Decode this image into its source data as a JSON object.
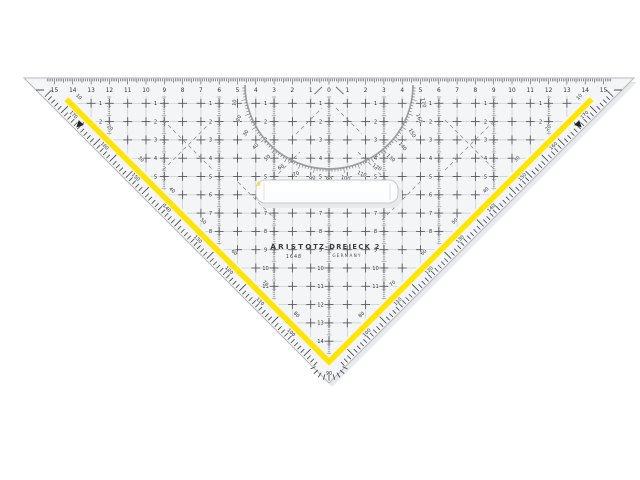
{
  "product": {
    "brand": "ARISTO",
    "model_number": "1648",
    "product_name": "TZ-DREIECK 2",
    "country": "GERMANY",
    "right_angle_label": "90"
  },
  "top_scale": {
    "unit_numbers": [
      "15",
      "14",
      "13",
      "12",
      "11",
      "10",
      "9",
      "8",
      "7",
      "6",
      "5",
      "4",
      "3",
      "2",
      "1",
      "0",
      "1",
      "2",
      "3",
      "4",
      "5",
      "6",
      "7",
      "8",
      "9",
      "10",
      "11",
      "12",
      "13",
      "14",
      "15"
    ]
  },
  "protractor": {
    "degree_labels": [
      "10",
      "20",
      "30",
      "40",
      "50",
      "60",
      "70",
      "80",
      "90",
      "100",
      "110",
      "120",
      "130",
      "140",
      "150",
      "160",
      "170"
    ]
  },
  "edge_scales": {
    "inner_degrees": [
      "10",
      "20",
      "30",
      "40",
      "50",
      "60",
      "70",
      "80"
    ],
    "outer_degrees": [
      "170",
      "160",
      "150",
      "140",
      "130",
      "120",
      "110",
      "100"
    ]
  },
  "interior_scales": {
    "column_row_counts": [
      2,
      5,
      8,
      11,
      14,
      11,
      8,
      5,
      2
    ]
  },
  "colors": {
    "body": "#f4f5f7",
    "edge_outline": "#b6b9be",
    "shadow": "#e8e9eb",
    "yellow": "#ffe500",
    "grid_line": "#c9ccd0",
    "grid_cross": "#55585c",
    "mm_tick": "#84878b",
    "scale_tick": "#3c3e41",
    "text": "#2f3134",
    "protractor_arc": "#9ea1a6",
    "protractor_tick": "#7b7e83",
    "diagonal": "#8d9094",
    "handle_fill": "#fdfdfe",
    "handle_stroke": "#c7cacd"
  }
}
